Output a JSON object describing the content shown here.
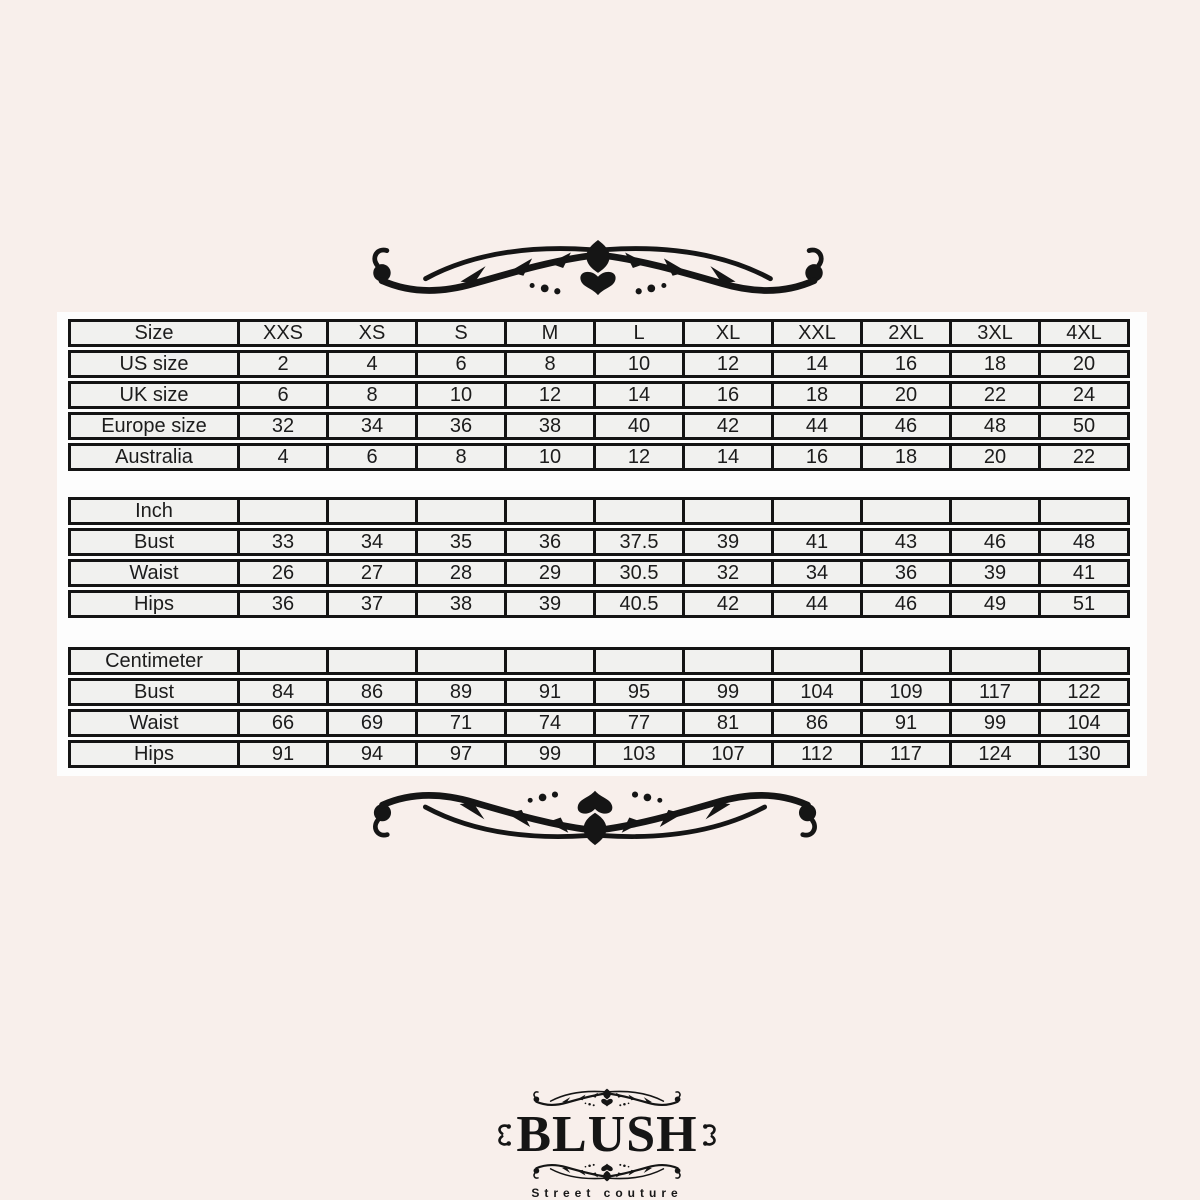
{
  "colors": {
    "page_background": "#f8efeb",
    "panel_background": "#fdfdfd",
    "cell_background": "#f1f1ef",
    "line_and_ink": "#141414"
  },
  "ornaments": {
    "top": "scroll-flourish",
    "bottom": "scroll-flourish-flipped",
    "logo_top_band": "small-scroll-flourish",
    "logo_bottom_band": "small-scroll-flourish-flipped",
    "logo_sides": "double-curl-ornament"
  },
  "size_chart": {
    "tables": [
      {
        "name": "size-conversion",
        "rows": [
          [
            "Size",
            "XXS",
            "XS",
            "S",
            "M",
            "L",
            "XL",
            "XXL",
            "2XL",
            "3XL",
            "4XL"
          ],
          [
            "US size",
            "2",
            "4",
            "6",
            "8",
            "10",
            "12",
            "14",
            "16",
            "18",
            "20"
          ],
          [
            "UK size",
            "6",
            "8",
            "10",
            "12",
            "14",
            "16",
            "18",
            "20",
            "22",
            "24"
          ],
          [
            "Europe size",
            "32",
            "34",
            "36",
            "38",
            "40",
            "42",
            "44",
            "46",
            "48",
            "50"
          ],
          [
            "Australia",
            "4",
            "6",
            "8",
            "10",
            "12",
            "14",
            "16",
            "18",
            "20",
            "22"
          ]
        ]
      },
      {
        "name": "inch-measurements",
        "rows": [
          [
            "Inch",
            "",
            "",
            "",
            "",
            "",
            "",
            "",
            "",
            "",
            ""
          ],
          [
            "Bust",
            "33",
            "34",
            "35",
            "36",
            "37.5",
            "39",
            "41",
            "43",
            "46",
            "48"
          ],
          [
            "Waist",
            "26",
            "27",
            "28",
            "29",
            "30.5",
            "32",
            "34",
            "36",
            "39",
            "41"
          ],
          [
            "Hips",
            "36",
            "37",
            "38",
            "39",
            "40.5",
            "42",
            "44",
            "46",
            "49",
            "51"
          ]
        ]
      },
      {
        "name": "centimeter-measurements",
        "rows": [
          [
            "Centimeter",
            "",
            "",
            "",
            "",
            "",
            "",
            "",
            "",
            "",
            ""
          ],
          [
            "Bust",
            "84",
            "86",
            "89",
            "91",
            "95",
            "99",
            "104",
            "109",
            "117",
            "122"
          ],
          [
            "Waist",
            "66",
            "69",
            "71",
            "74",
            "77",
            "81",
            "86",
            "91",
            "99",
            "104"
          ],
          [
            "Hips",
            "91",
            "94",
            "97",
            "99",
            "103",
            "107",
            "112",
            "117",
            "124",
            "130"
          ]
        ]
      }
    ]
  },
  "logo": {
    "brand": "BLUSH",
    "tagline": "Street couture"
  }
}
